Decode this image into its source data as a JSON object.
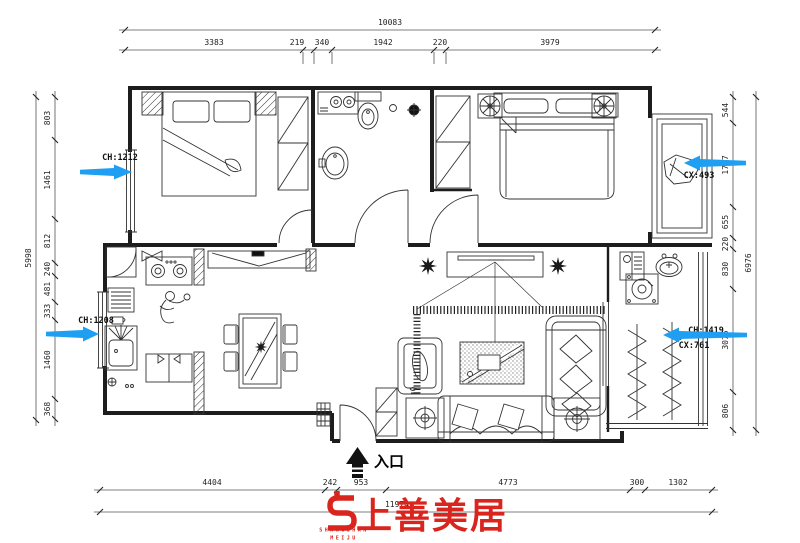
{
  "dims": {
    "top": {
      "overall": "10083",
      "segments": [
        "3383",
        "219",
        "340",
        "1942",
        "220",
        "3979"
      ]
    },
    "left": {
      "overall": "5998",
      "segments": [
        "803",
        "1461",
        "812",
        "240",
        "481",
        "333",
        "1460",
        "368"
      ]
    },
    "right": {
      "overall": "6976",
      "segments": [
        "544",
        "1767",
        "655",
        "220",
        "830",
        "3075",
        "806"
      ]
    },
    "bottom": {
      "overall": "11974",
      "segments": [
        "4404",
        "242",
        "953",
        "4773",
        "300",
        "1302"
      ]
    }
  },
  "window_annotations": {
    "left_upper": {
      "line1": "CH:1212"
    },
    "left_lower": {
      "line1": "CH:1208"
    },
    "right_upper": {
      "line2": "CX:493"
    },
    "right_lower": {
      "line1": "CH:1419",
      "line2": "CX:761"
    }
  },
  "entrance": {
    "label": "入口"
  },
  "logo": {
    "brand_cn": "上善美居",
    "brand_en_top": "SHANGSHAN",
    "brand_en_bottom": "MEIJU"
  },
  "colors": {
    "annotation_arrow": "#1e9ff2",
    "brand_red": "#d9251d",
    "line": "#222222"
  }
}
